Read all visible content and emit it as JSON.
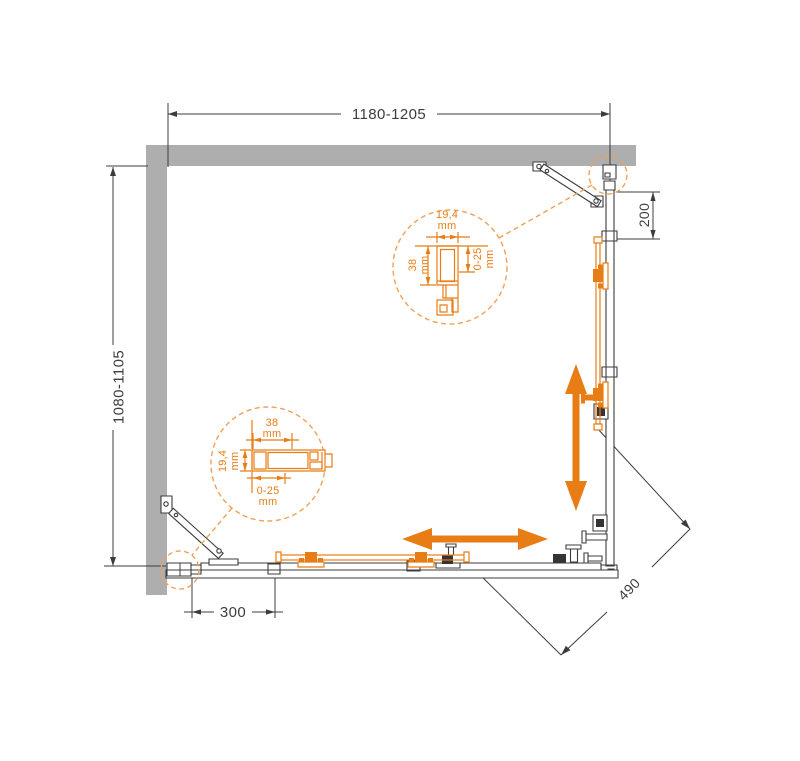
{
  "drawing": {
    "type": "shower-enclosure-plan-technical-drawing",
    "colors": {
      "accent_orange": "#E87D15",
      "accent_orange_light": "#F2A057",
      "wall_gray": "#AEAEAE",
      "line_dark": "#3C3C3C"
    },
    "dimensions": {
      "width_range": "1180-1205",
      "depth_range": "1080-1105",
      "side_fixed_offset": "200",
      "front_fixed_offset": "300",
      "diagonal_entry": "490"
    },
    "detail_top": {
      "width_value": "19,4",
      "width_unit": "mm",
      "depth_value": "38",
      "depth_unit": "mm",
      "adjust_value": "0-25",
      "adjust_unit": "mm"
    },
    "detail_bottom": {
      "width_value": "38",
      "width_unit": "mm",
      "depth_value": "19,4",
      "depth_unit": "mm",
      "adjust_value": "0-25",
      "adjust_unit": "mm"
    }
  }
}
